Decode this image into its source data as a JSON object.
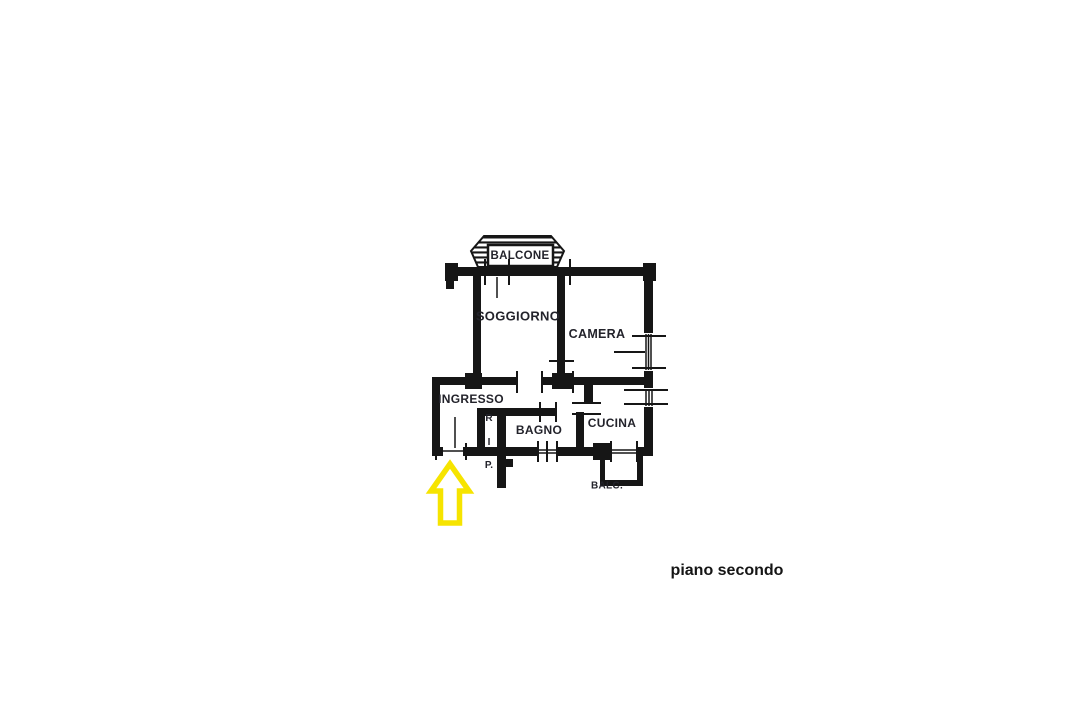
{
  "floor_plan": {
    "caption": "piano secondo",
    "rooms": {
      "balcone": "BALCONE",
      "soggiorno": "SOGGIORNO",
      "camera": "CAMERA",
      "ingresso": "INGRESSO",
      "ripostiglio": {
        "letters": [
          "R",
          "I",
          "P."
        ]
      },
      "bagno": "BAGNO",
      "cucina": "CUCINA",
      "balc": "BALC."
    },
    "annotations": {
      "entrance_arrow": "yellow up block arrow marking apartment entrance door"
    },
    "colors": {
      "walls": "#161616",
      "label_text": "#23232b",
      "arrow_outline": "#f6e400",
      "arrow_fill": "#ffffff",
      "background": "#ffffff"
    }
  }
}
